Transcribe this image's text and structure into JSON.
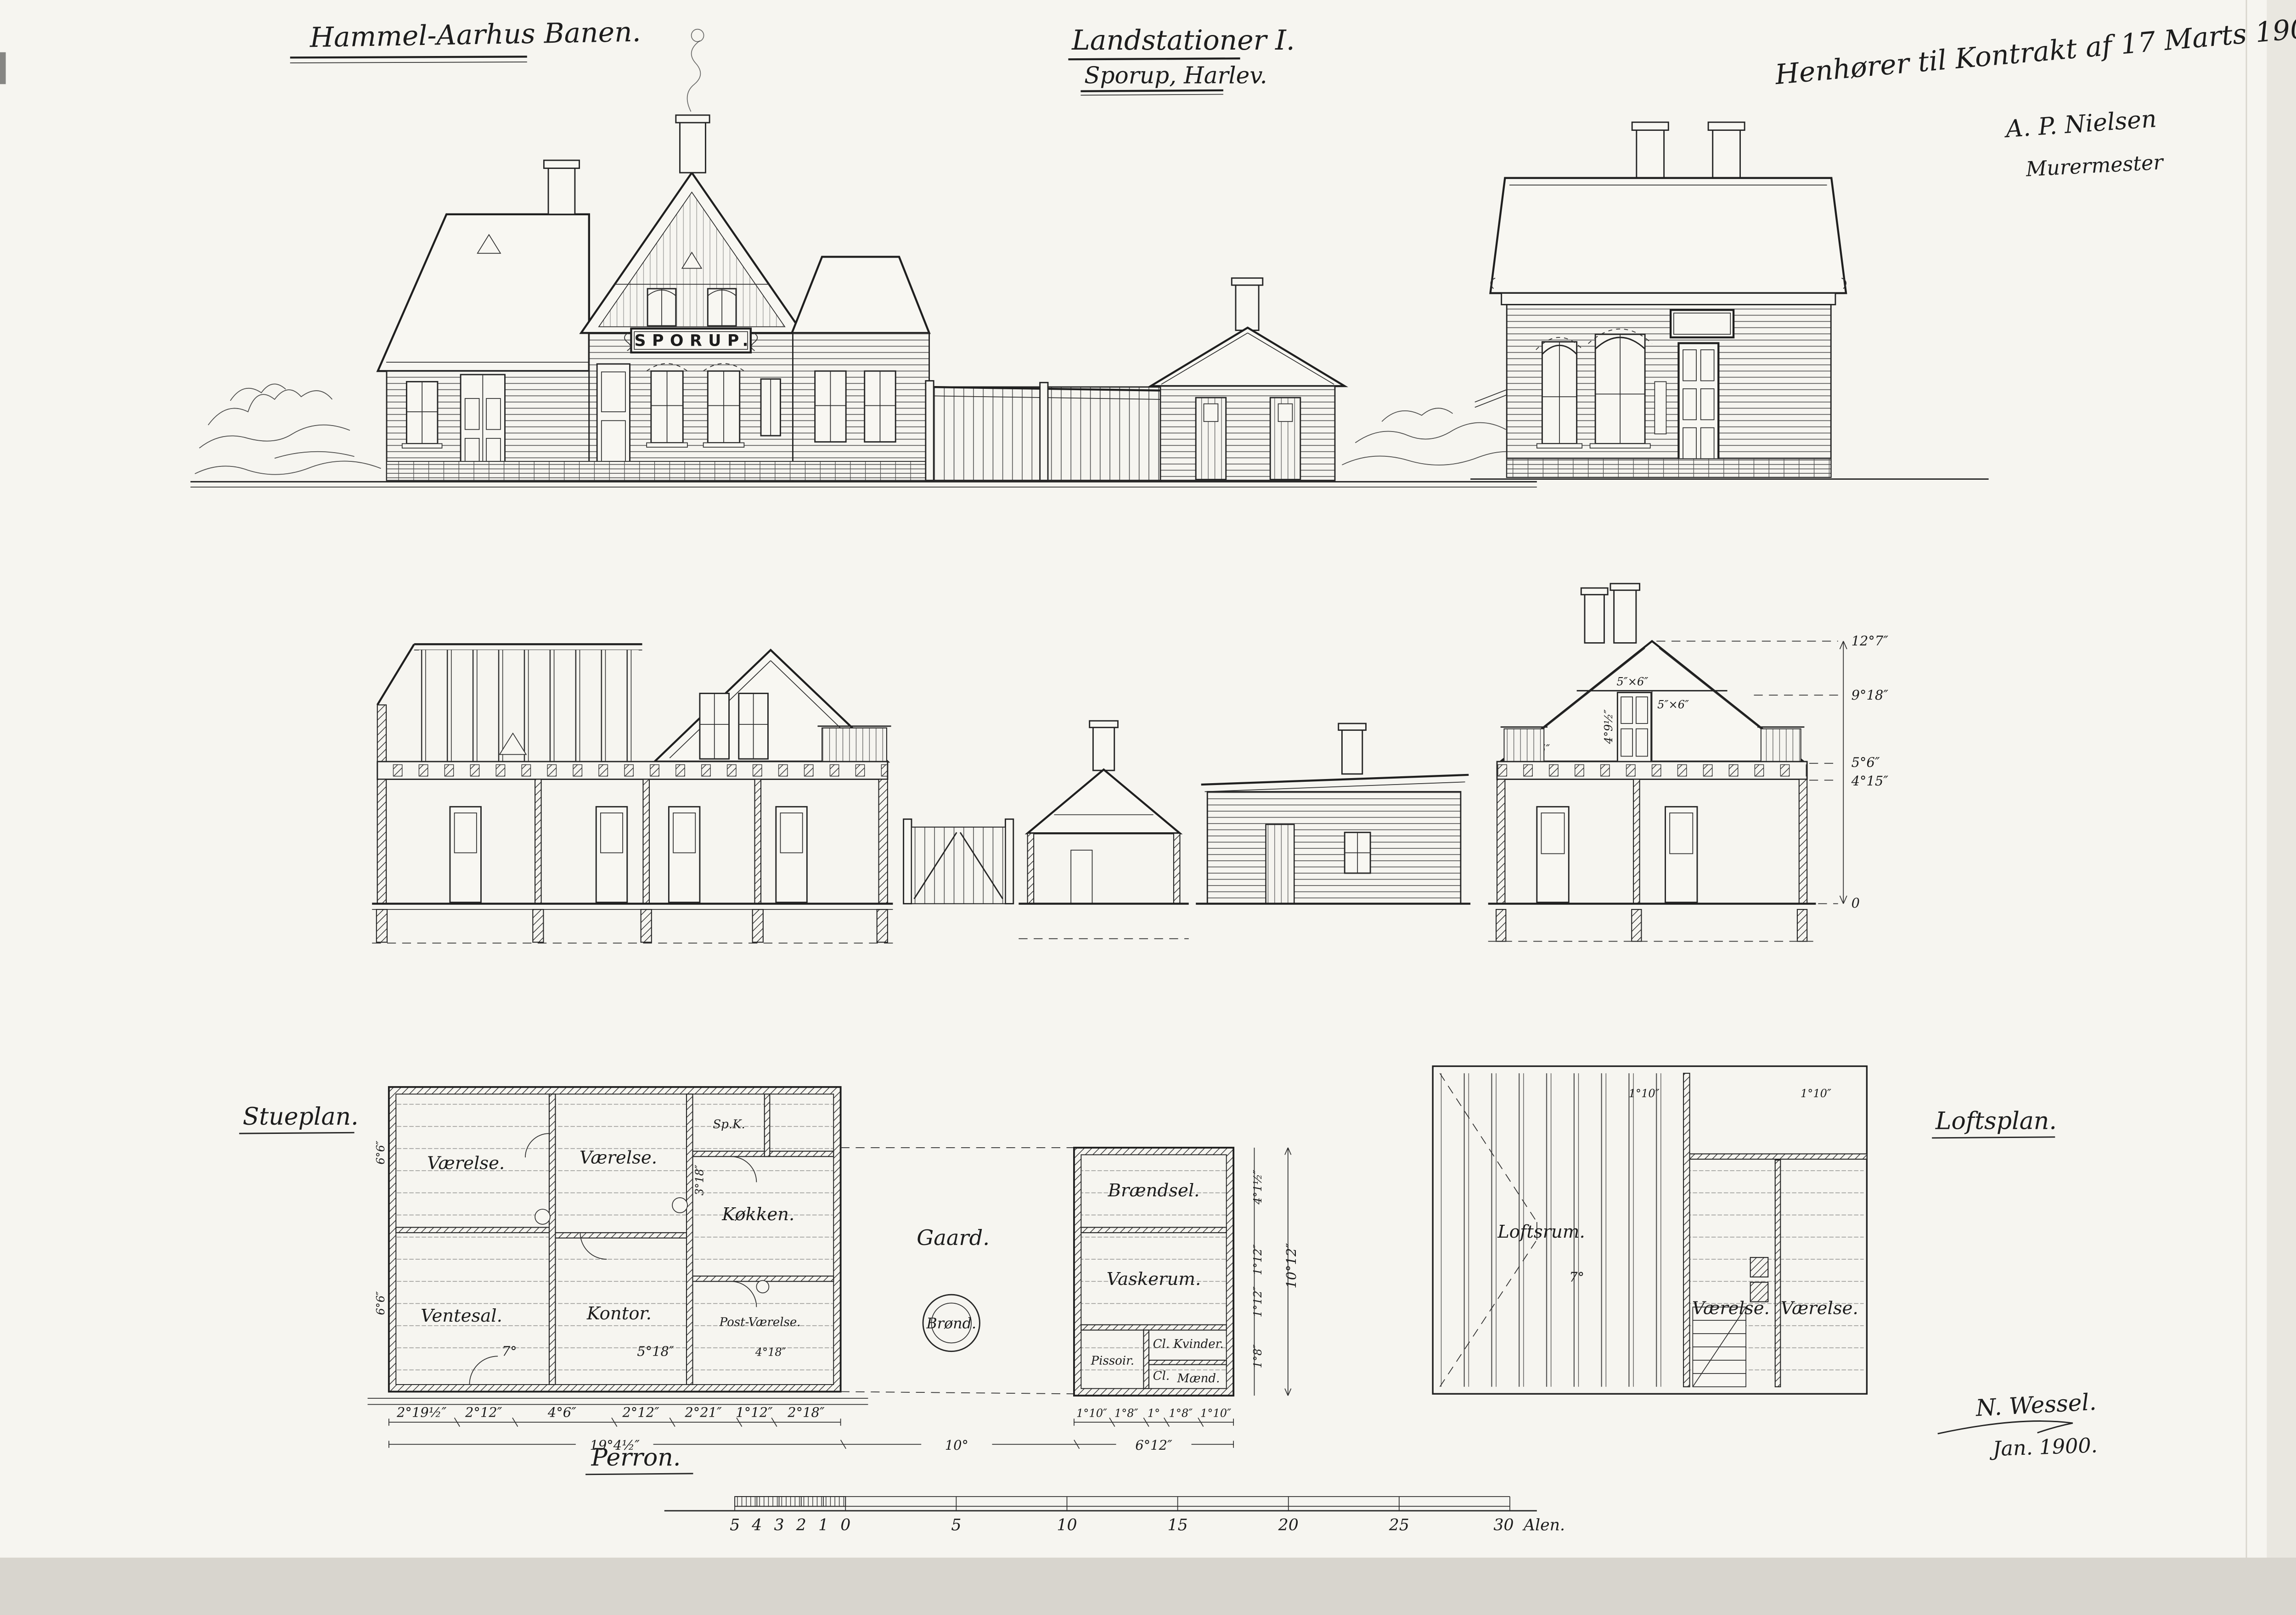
{
  "titles": {
    "railway": "Hammel-Aarhus Banen.",
    "sheet": "Landstationer I.",
    "subtitle": "Sporup, Harlev.",
    "contract_note": "Henhører til Kontrakt af 17 Marts 1900.",
    "contractor_name": "A. P. Nielsen",
    "contractor_role": "Murermester"
  },
  "station_sign": "SPORUP.",
  "plan_labels": {
    "ground": "Stueplan.",
    "loft": "Loftsplan.",
    "platform": "Perron."
  },
  "rooms": {
    "ground": [
      "Værelse.",
      "Værelse.",
      "Sp.K.",
      "Ventesal.",
      "Kontor.",
      "Køkken.",
      "Post-Værelse.",
      "Gaard.",
      "Brønd."
    ],
    "outbuilding": [
      "Brændsel.",
      "Vaskerum.",
      "Pissoir.",
      "Cl.",
      "Kvinder.",
      "Cl.",
      "Mænd."
    ],
    "loft": [
      "Loftsrum.",
      "Værelse.",
      "Værelse."
    ]
  },
  "dims": {
    "ground_bottom": [
      "2°19½″",
      "2°12″",
      "4°6″",
      "2°12″",
      "2°21″",
      "1°12″",
      "2°18″"
    ],
    "ground_total": "19°4½″",
    "yard_width": "10°",
    "outbuilding_width": "6°12″",
    "outbuilding_bottom": [
      "1°10″",
      "1°8″",
      "1°",
      "1°8″",
      "1°10″"
    ],
    "section_heights": [
      "12°7″",
      "9°18″",
      "5°6″",
      "4°15″",
      "0"
    ],
    "timber": [
      "5″×6″",
      "5″×6″",
      "4″×5″",
      "4°9½″"
    ],
    "interior": [
      "6°6″",
      "6°6″",
      "3°18″",
      "7°",
      "5°18″",
      "4°18″",
      "7°",
      "1°10″",
      "1°10″"
    ],
    "outbuilding_right": [
      "4°1½″",
      "1°12″",
      "1°12″",
      "1°8″"
    ],
    "outbuilding_right_total": "10°12″"
  },
  "scale_bar": {
    "minor": [
      "5",
      "4",
      "3",
      "2",
      "1",
      "0"
    ],
    "major": [
      "5",
      "10",
      "15",
      "20",
      "25",
      "30"
    ],
    "unit": "Alen."
  },
  "signature": {
    "name": "N. Wessel.",
    "date": "Jan. 1900."
  }
}
